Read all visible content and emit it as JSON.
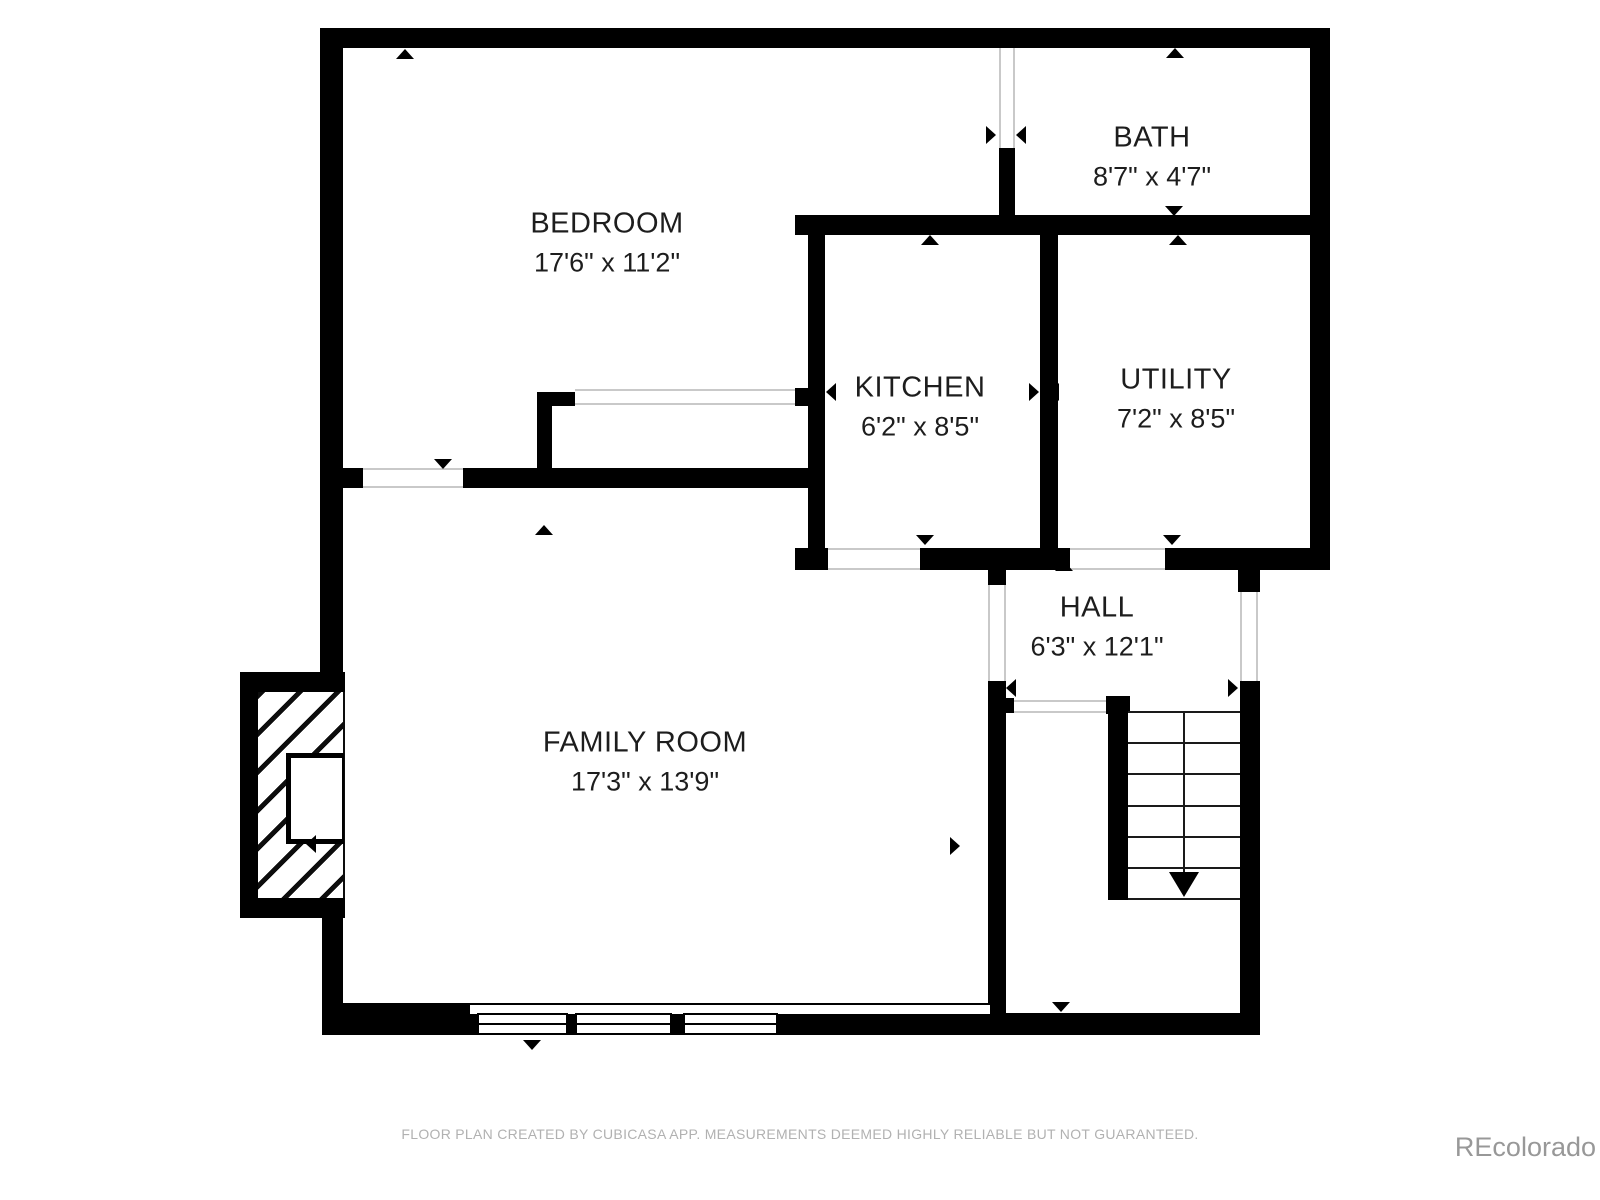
{
  "title": "Floor plan",
  "footer_note": "FLOOR PLAN CREATED BY CUBICASA APP. MEASUREMENTS DEEMED HIGHLY RELIABLE BUT NOT GUARANTEED.",
  "watermark": "REcolorado",
  "rooms": [
    {
      "slug": "bedroom",
      "name": "BEDROOM",
      "dims": "17'6\" x 11'2\"",
      "cx": 607,
      "cy": 243
    },
    {
      "slug": "bath",
      "name": "BATH",
      "dims": "8'7\" x 4'7\"",
      "cx": 1152,
      "cy": 157
    },
    {
      "slug": "kitchen",
      "name": "KITCHEN",
      "dims": "6'2\" x 8'5\"",
      "cx": 920,
      "cy": 407
    },
    {
      "slug": "utility",
      "name": "UTILITY",
      "dims": "7'2\" x 8'5\"",
      "cx": 1176,
      "cy": 399
    },
    {
      "slug": "hall",
      "name": "HALL",
      "dims": "6'3\" x 12'1\"",
      "cx": 1097,
      "cy": 627
    },
    {
      "slug": "family-room",
      "name": "FAMILY ROOM",
      "dims": "17'3\" x 13'9\"",
      "cx": 645,
      "cy": 762
    }
  ],
  "plan": {
    "colors": {
      "wall": "#000000",
      "text": "#1d1d1d",
      "thin_line": "#c9c9c9",
      "footer": "#b1b1b1",
      "watermark": "#989898"
    },
    "walls": [
      {
        "x": 320,
        "y": 28,
        "w": 1010,
        "h": 20
      },
      {
        "x": 320,
        "y": 28,
        "w": 23,
        "h": 444
      },
      {
        "x": 320,
        "y": 468,
        "w": 492,
        "h": 20
      },
      {
        "x": 320,
        "y": 486,
        "w": 23,
        "h": 188
      },
      {
        "x": 240,
        "y": 672,
        "w": 105,
        "h": 20
      },
      {
        "x": 240,
        "y": 672,
        "w": 18,
        "h": 246
      },
      {
        "x": 240,
        "y": 898,
        "w": 105,
        "h": 20
      },
      {
        "x": 322,
        "y": 916,
        "w": 21,
        "h": 119
      },
      {
        "x": 322,
        "y": 1003,
        "w": 150,
        "h": 32
      },
      {
        "x": 470,
        "y": 1013,
        "w": 520,
        "h": 22
      },
      {
        "x": 990,
        "y": 1013,
        "w": 270,
        "h": 22
      },
      {
        "x": 988,
        "y": 548,
        "w": 18,
        "h": 37
      },
      {
        "x": 988,
        "y": 681,
        "w": 18,
        "h": 354
      },
      {
        "x": 1006,
        "y": 698,
        "w": 8,
        "h": 15
      },
      {
        "x": 1106,
        "y": 696,
        "w": 24,
        "h": 18
      },
      {
        "x": 1108,
        "y": 696,
        "w": 20,
        "h": 204
      },
      {
        "x": 795,
        "y": 548,
        "w": 535,
        "h": 22
      },
      {
        "x": 1310,
        "y": 28,
        "w": 20,
        "h": 540
      },
      {
        "x": 1238,
        "y": 560,
        "w": 22,
        "h": 32
      },
      {
        "x": 1240,
        "y": 681,
        "w": 20,
        "h": 354
      },
      {
        "x": 808,
        "y": 232,
        "w": 17,
        "h": 320
      },
      {
        "x": 795,
        "y": 388,
        "w": 14,
        "h": 18
      },
      {
        "x": 795,
        "y": 215,
        "w": 535,
        "h": 20
      },
      {
        "x": 999,
        "y": 148,
        "w": 16,
        "h": 70
      },
      {
        "x": 1040,
        "y": 235,
        "w": 18,
        "h": 315
      },
      {
        "x": 537,
        "y": 392,
        "w": 15,
        "h": 78
      },
      {
        "x": 537,
        "y": 392,
        "w": 38,
        "h": 14
      }
    ],
    "openings": [
      {
        "name": "bath-door-opening",
        "x": 999,
        "y": 48,
        "w": 16,
        "h": 100,
        "o": "v"
      },
      {
        "name": "bedroom-door-opening",
        "x": 363,
        "y": 468,
        "w": 100,
        "h": 20,
        "o": "h"
      },
      {
        "name": "closet-slider-opening",
        "x": 575,
        "y": 389,
        "w": 220,
        "h": 16,
        "o": "h"
      },
      {
        "name": "kitchen-door-opening",
        "x": 828,
        "y": 548,
        "w": 92,
        "h": 22,
        "o": "h"
      },
      {
        "name": "utility-door-opening",
        "x": 1070,
        "y": 548,
        "w": 95,
        "h": 22,
        "o": "h"
      },
      {
        "name": "hall-passage-opening",
        "x": 988,
        "y": 585,
        "w": 18,
        "h": 96,
        "o": "v"
      },
      {
        "name": "stair-opening",
        "x": 1014,
        "y": 700,
        "w": 92,
        "h": 13,
        "o": "h"
      },
      {
        "name": "hall-window",
        "x": 1240,
        "y": 592,
        "w": 18,
        "h": 89,
        "o": "v"
      }
    ],
    "window_strip": {
      "x": 470,
      "y": 1003,
      "w": 520,
      "h": 11
    },
    "windows": [
      {
        "x": 477,
        "y": 1013,
        "w": 91,
        "h": 22
      },
      {
        "x": 575,
        "y": 1013,
        "w": 97,
        "h": 22
      },
      {
        "x": 683,
        "y": 1013,
        "w": 95,
        "h": 22
      }
    ],
    "markers": [
      {
        "x": 405,
        "y": 54,
        "dir": "up"
      },
      {
        "x": 443,
        "y": 464,
        "dir": "down"
      },
      {
        "x": 336,
        "y": 135,
        "dir": "left"
      },
      {
        "x": 991,
        "y": 135,
        "dir": "right"
      },
      {
        "x": 1175,
        "y": 53,
        "dir": "up"
      },
      {
        "x": 1174,
        "y": 211,
        "dir": "down"
      },
      {
        "x": 1021,
        "y": 135,
        "dir": "left"
      },
      {
        "x": 1325,
        "y": 135,
        "dir": "right"
      },
      {
        "x": 930,
        "y": 240,
        "dir": "up"
      },
      {
        "x": 925,
        "y": 540,
        "dir": "down"
      },
      {
        "x": 831,
        "y": 392,
        "dir": "left"
      },
      {
        "x": 1034,
        "y": 392,
        "dir": "right"
      },
      {
        "x": 1178,
        "y": 240,
        "dir": "up"
      },
      {
        "x": 1172,
        "y": 540,
        "dir": "down"
      },
      {
        "x": 1054,
        "y": 392,
        "dir": "left"
      },
      {
        "x": 1325,
        "y": 390,
        "dir": "right"
      },
      {
        "x": 1064,
        "y": 566,
        "dir": "up"
      },
      {
        "x": 1061,
        "y": 1007,
        "dir": "down"
      },
      {
        "x": 1011,
        "y": 688,
        "dir": "left"
      },
      {
        "x": 1233,
        "y": 688,
        "dir": "right"
      },
      {
        "x": 544,
        "y": 530,
        "dir": "up"
      },
      {
        "x": 532,
        "y": 1045,
        "dir": "down"
      },
      {
        "x": 311,
        "y": 844,
        "dir": "left"
      },
      {
        "x": 955,
        "y": 846,
        "dir": "right"
      }
    ],
    "stairs": {
      "x": 1128,
      "y": 711,
      "w": 112,
      "h": 187,
      "rows": 6,
      "center_x": 56,
      "line_h": 160
    },
    "fireplace": {
      "hatch": {
        "x": 258,
        "y": 692,
        "w": 87,
        "h": 206
      },
      "firebox": {
        "x": 286,
        "y": 753,
        "w": 58,
        "h": 91
      }
    }
  }
}
